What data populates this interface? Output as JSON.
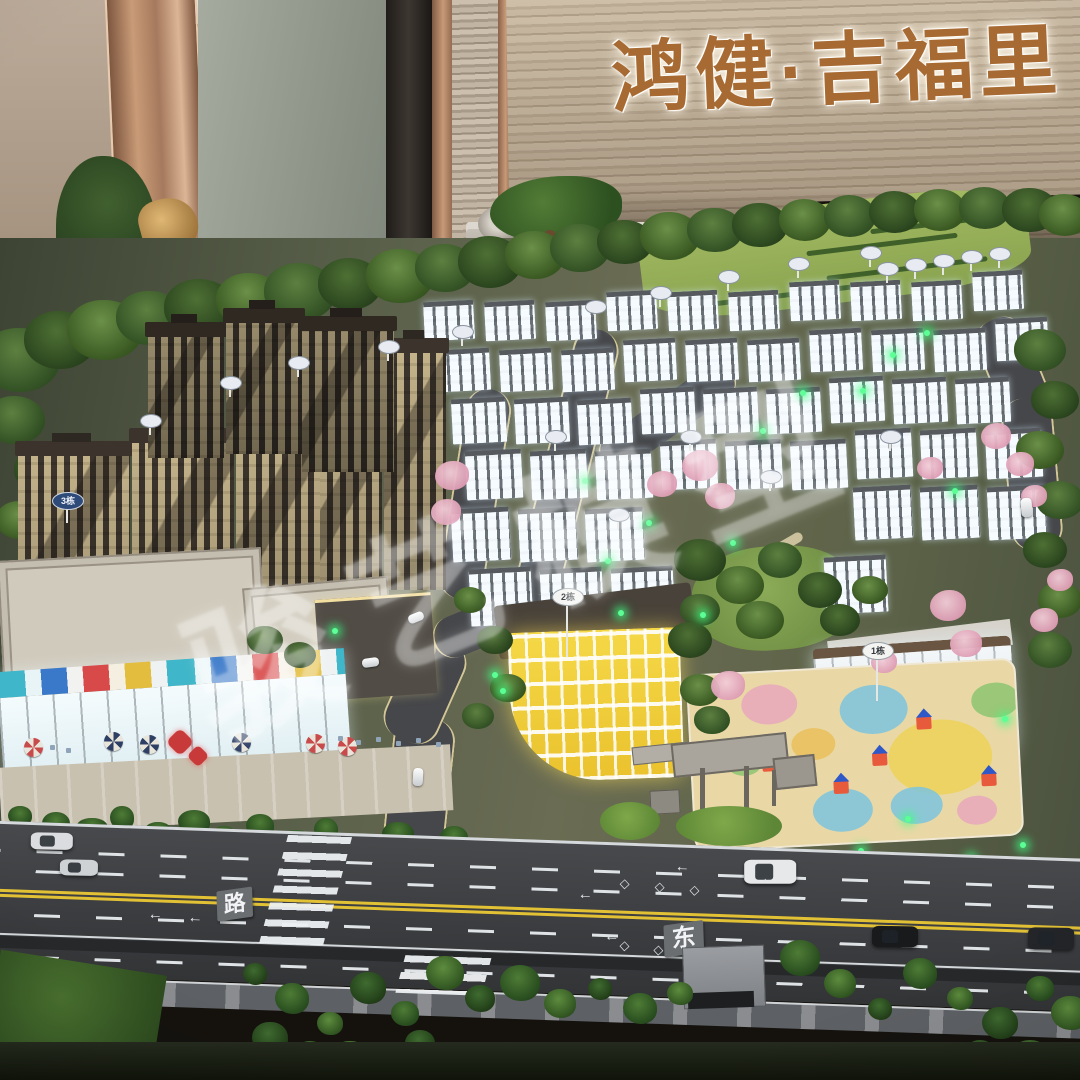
{
  "signage": {
    "project_name": "鸿健·吉福里"
  },
  "watermark": {
    "text": "骏艺模型"
  },
  "road_markings": {
    "west_label": "路",
    "east_label": "东"
  },
  "building_signs": {
    "b1": "1栋",
    "b2": "2栋",
    "b3": "3栋"
  },
  "colors": {
    "sign_bronze": "#a76a33",
    "feature_wall": "#bfae98",
    "pillar_rose_gold": "#b98a68",
    "double_yellow_line": "#e2c135",
    "kindergarten_glow": "#f0cf3e",
    "townhouse_glow": "#eaf4ff",
    "led_green": "#3cf07a"
  }
}
